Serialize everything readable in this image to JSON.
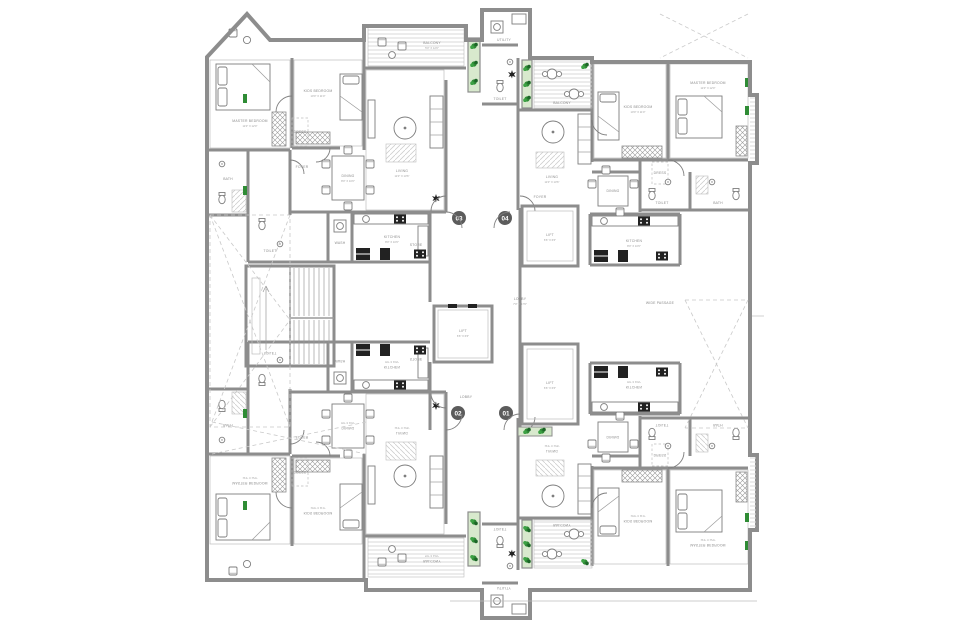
{
  "document": {
    "type": "apartment-typical-floor-plan",
    "background": "#ffffff",
    "units_per_floor": 4
  },
  "colors": {
    "wall": "#8d8d8d",
    "partition": "#bdbdbd",
    "furniture_line": "#7e7e7e",
    "hatch": "#d4d4d4",
    "planter_fill": "#d8e9cd",
    "plant_green": "#2f8c35",
    "plant_dark": "#1d6628",
    "appliance_black": "#222222",
    "label_text": "#8a8a8a",
    "unit_badge_fill": "#5c5c5c",
    "dashed_line": "#c9c9c9"
  },
  "units": [
    {
      "number": "01",
      "position": "bottom-right"
    },
    {
      "number": "02",
      "position": "bottom-left"
    },
    {
      "number": "03",
      "position": "top-left"
    },
    {
      "number": "04",
      "position": "top-right"
    }
  ],
  "rooms": {
    "master_bedroom": {
      "name": "MASTER BEDROOM",
      "dim": "11'0\" X 12'0\""
    },
    "kids_bedroom": {
      "name": "KIDS BEDROOM",
      "dim": "10'0\" X 11'0\""
    },
    "living": {
      "name": "LIVING",
      "dim": "11'0\" X 13'6\""
    },
    "dining": {
      "name": "DINING",
      "dim": "8'0\" X 10'0\""
    },
    "kitchen": {
      "name": "KITCHEN",
      "dim": "8'0\" X 10'6\""
    },
    "wash": {
      "name": "WASH",
      "dim": "4'0\" X 4'6\""
    },
    "store": {
      "name": "STORE",
      "dim": "4'0\" X 5'0\""
    },
    "bath": {
      "name": "BATH",
      "dim": "5'0\" X 8'0\""
    },
    "toilet": {
      "name": "TOILET",
      "dim": "4'6\" X 8'0\""
    },
    "dress": {
      "name": "DRESS",
      "dim": "4'6\" X 5'6\""
    },
    "balcony": {
      "name": "BALCONY",
      "dim": "5'0\" X 12'0\""
    },
    "utility": {
      "name": "UTILITY",
      "dim": "4'0\" X 7'0\""
    },
    "foyer": {
      "name": "FOYER"
    },
    "lobby": {
      "name": "LOBBY",
      "dim": "7'0\" X 17'6\""
    },
    "lift": {
      "name": "LIFT",
      "dim": "6'6\" X 6'6\""
    },
    "passage": {
      "name": "WIDE PASSAGE"
    }
  }
}
